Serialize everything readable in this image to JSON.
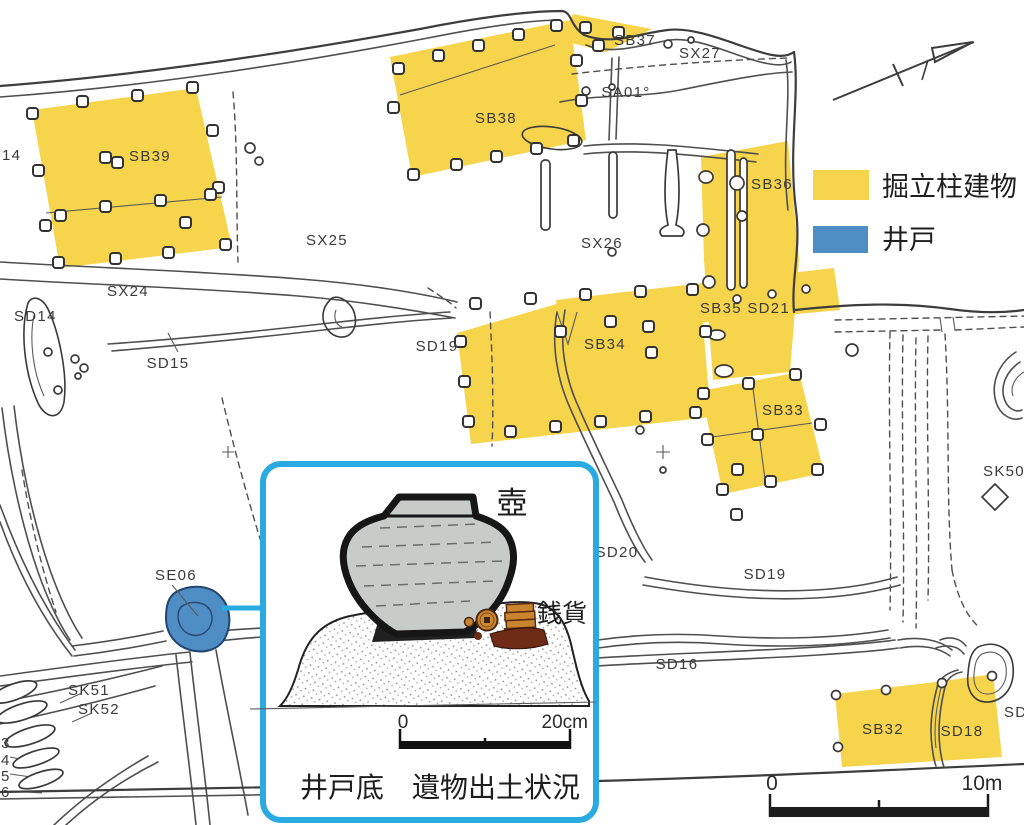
{
  "legend": {
    "building_label": "掘立柱建物",
    "well_label": "井戸",
    "building_color": "#F6D44C",
    "well_color": "#4E8EC5",
    "inset_border_color": "#29ABE2"
  },
  "site_labels": {
    "l14": "14",
    "sb39": "SB39",
    "sb38": "SB38",
    "sb37": "SB37",
    "sx27": "SX27",
    "sa01": "SA01°",
    "sb36": "SB36",
    "sx25": "SX25",
    "sx26": "SX26",
    "sx24": "SX24",
    "sd14": "SD14",
    "sd15": "SD15",
    "sd19_west": "SD19",
    "sb34": "SB34",
    "sb35_sd21": "SB35 SD21",
    "sb33": "SB33",
    "sk50": "SK50",
    "sd20": "SD20",
    "sd19_east": "SD19",
    "sd16": "SD16",
    "se06": "SE06",
    "sk51": "SK51",
    "sk52": "SK52",
    "n3": "3",
    "n4": "4",
    "n5": "5",
    "n6": "6",
    "sb32": "SB32",
    "sd18": "SD18",
    "sd_partial": "SD"
  },
  "inset": {
    "pot_label": "壺",
    "coins_label": "銭貨",
    "caption": "井戸底　遺物出土状況",
    "scale_start": "0",
    "scale_end": "20cm"
  },
  "map_scale": {
    "start": "0",
    "end": "10m"
  }
}
